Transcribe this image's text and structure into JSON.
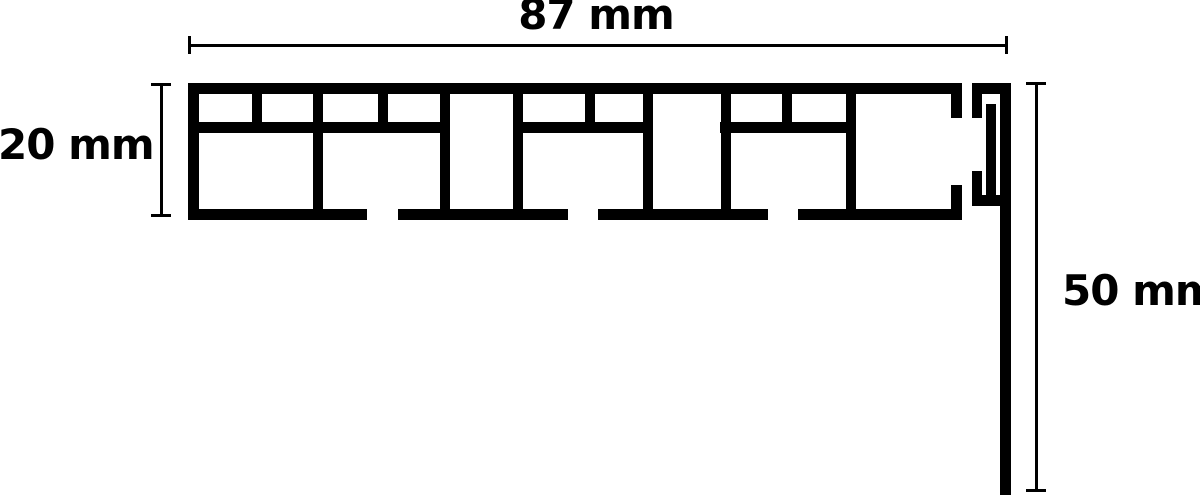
{
  "page": {
    "background_color": "#ffffff",
    "line_color": "#000000"
  },
  "diagram": {
    "kind": "profile-cross-section",
    "dimensions": {
      "width": {
        "label": "87 mm",
        "value": 87,
        "unit": "mm"
      },
      "height": {
        "label": "20 mm",
        "value": 20,
        "unit": "mm"
      },
      "drop": {
        "label": "50 mm",
        "value": 50,
        "unit": "mm"
      }
    }
  }
}
